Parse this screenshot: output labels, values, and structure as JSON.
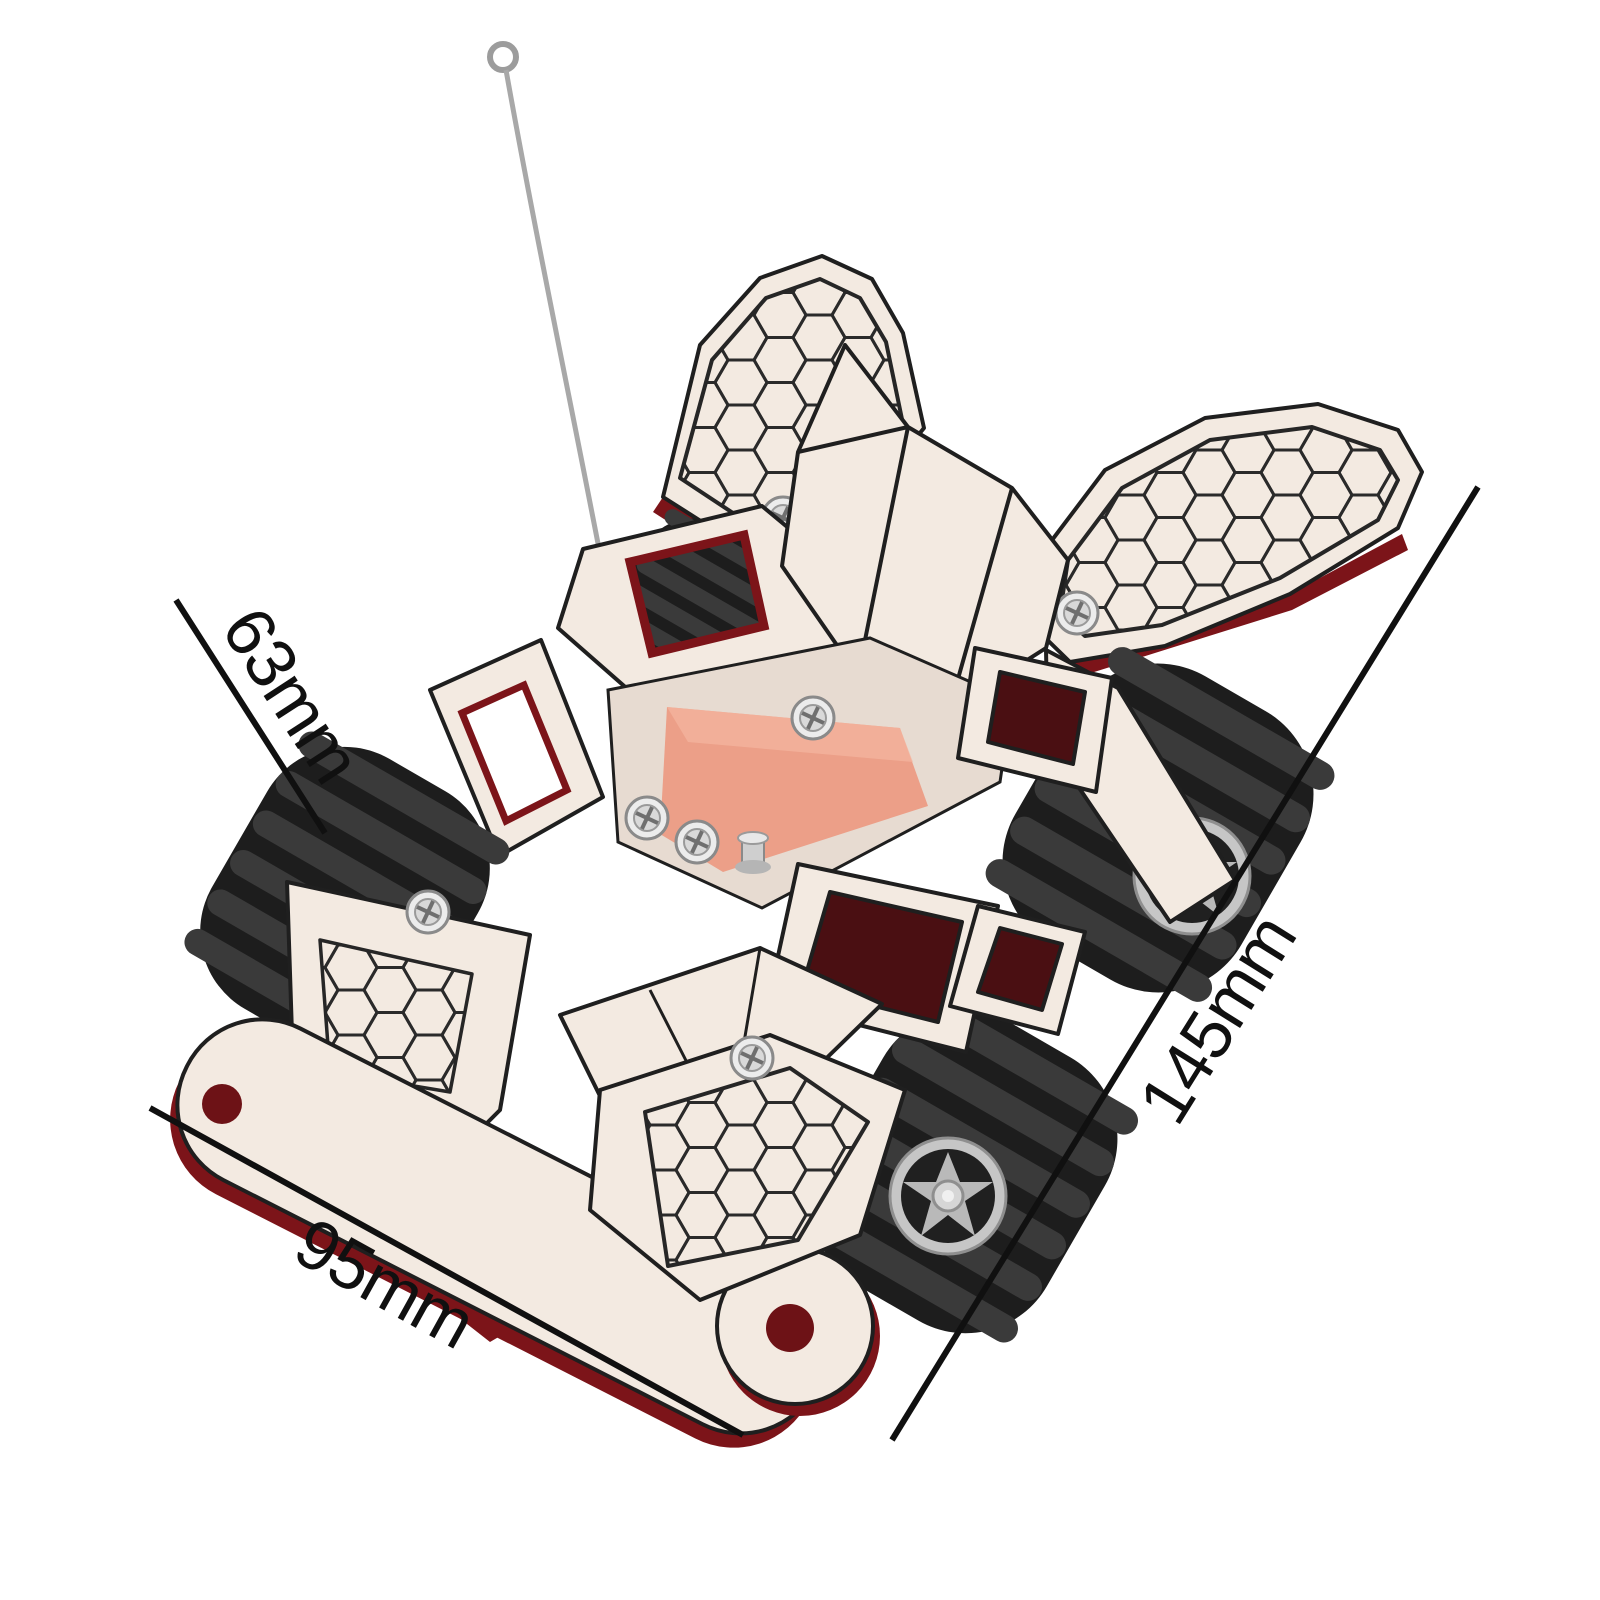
{
  "diagram": {
    "background": "#ffffff",
    "subject": "diy-wooden-rc-car-dimension-diagram",
    "labels": {
      "height": "63mm",
      "length": "145mm",
      "width": "95mm"
    },
    "colors": {
      "background": "#ffffff",
      "wood": "#f3eae1",
      "wood_shadow": "#e6d9cd",
      "edge": "#7c1419",
      "edge_dark": "#5a0f13",
      "outline": "#1f1f1f",
      "honeycomb_line": "#2a2a2a",
      "tire": "#1d1d1d",
      "tread": "#3a3a3a",
      "rim": "#c6c6c6",
      "pcb": "#ec9f88",
      "pcb_light": "#f5b7a1",
      "screw": "#d9d9d9",
      "antenna": "#a5a5a5",
      "dimension_line": "#101010"
    }
  }
}
